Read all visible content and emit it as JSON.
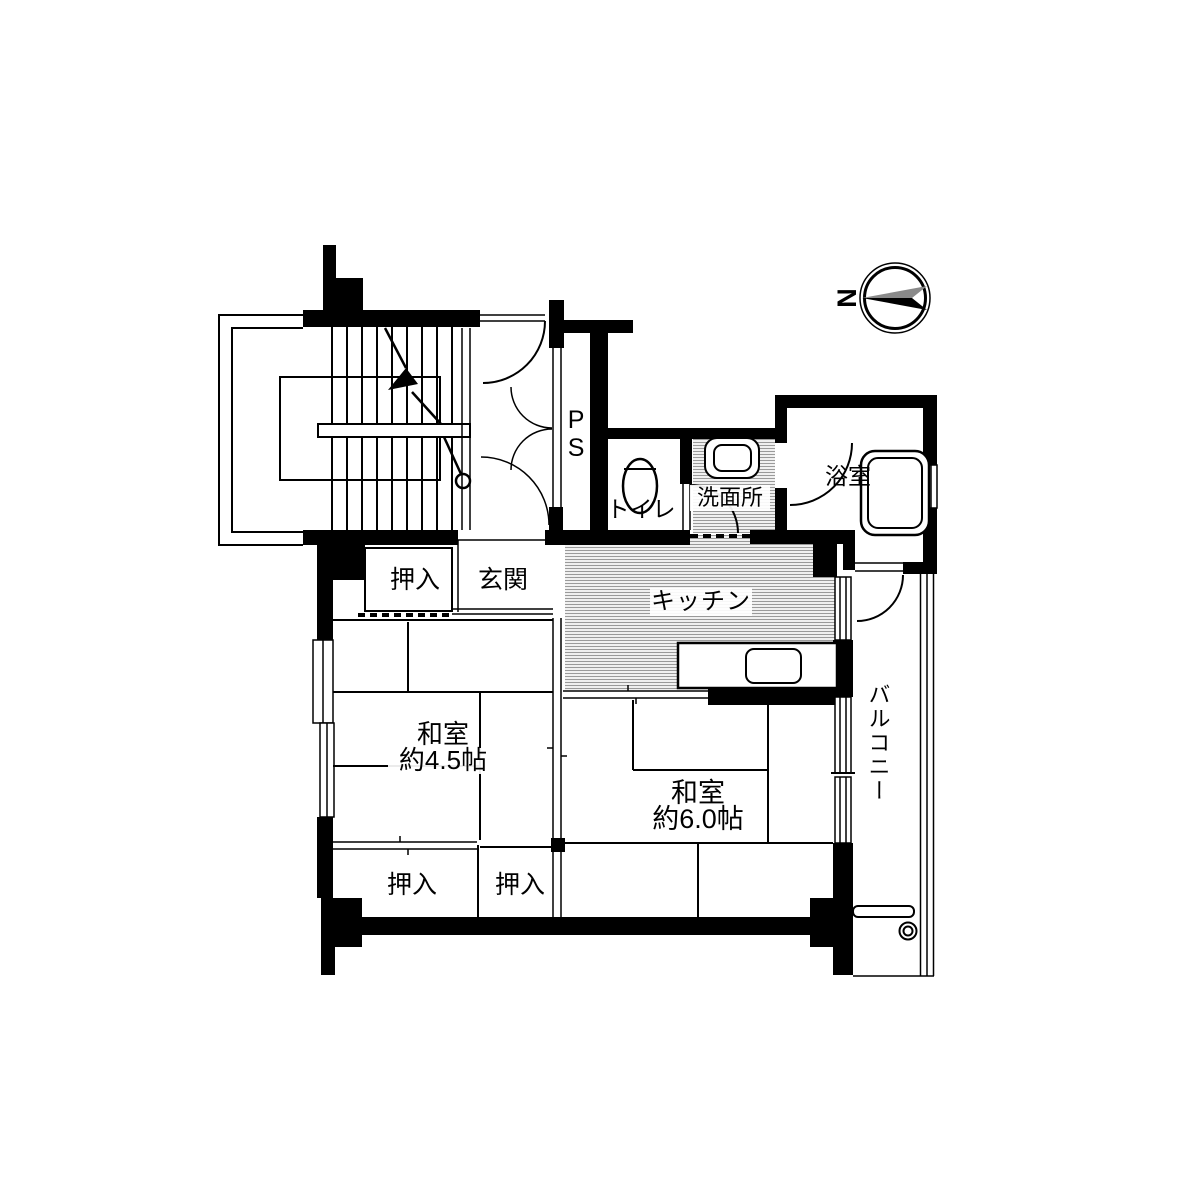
{
  "compass": {
    "north_label": "N"
  },
  "rooms": {
    "pipe_space": {
      "label": "PS"
    },
    "toilet": {
      "label": "トイレ"
    },
    "washroom": {
      "label": "洗面所"
    },
    "bathroom": {
      "label": "浴室"
    },
    "kitchen": {
      "label": "キッチン"
    },
    "entrance": {
      "label": "玄関"
    },
    "closet_upper": {
      "label": "押入"
    },
    "closet_lower_left": {
      "label": "押入"
    },
    "closet_lower_right": {
      "label": "押入"
    },
    "japanese_room_4_5": {
      "label": "和室",
      "size": "約4.5帖"
    },
    "japanese_room_6_0": {
      "label": "和室",
      "size": "約6.0帖"
    },
    "balcony": {
      "label": "バルコニー"
    }
  },
  "colors": {
    "wall": "#000000",
    "floor_hatch_line": "#9a9a9a",
    "compass_gray": "#8a8a8a"
  }
}
